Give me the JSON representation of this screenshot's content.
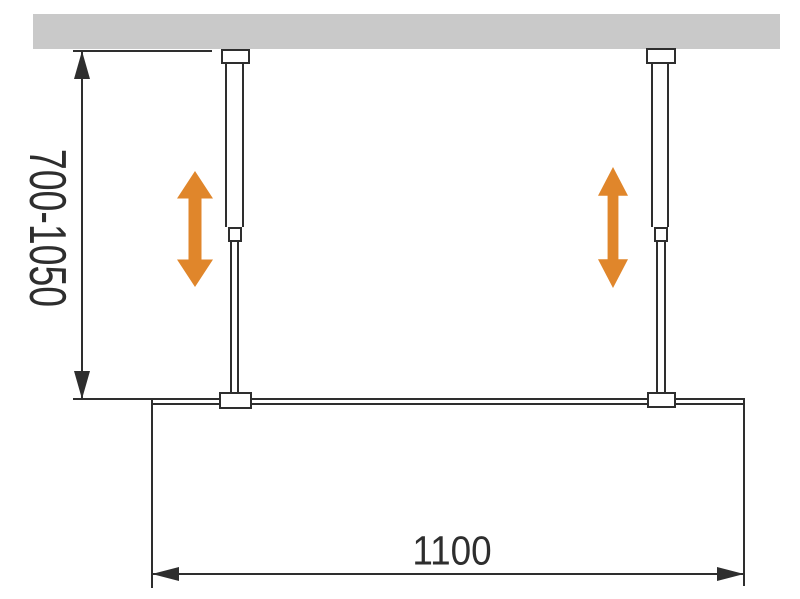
{
  "diagram": {
    "dimensions": {
      "height_range": "700-1050",
      "width": "1100"
    },
    "colors": {
      "ceiling": "#C9C9C9",
      "line": "#2E2E2E",
      "accent_orange": "#E0862B",
      "background": "#FFFFFF"
    },
    "icons": {
      "adjustment_arrow": "double-arrow-vertical",
      "dimension_arrowhead": "triangle"
    }
  }
}
